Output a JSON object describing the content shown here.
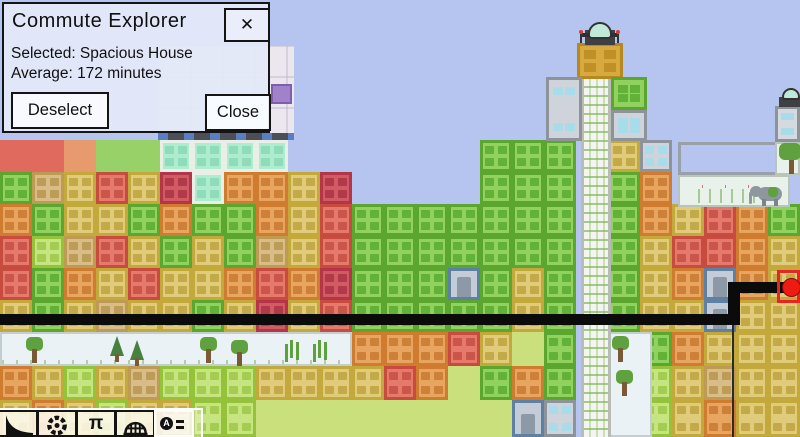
{
  "window": {
    "title": "Commute Explorer",
    "close_x": "✕"
  },
  "dialog": {
    "selected_line": "Selected: Spacious House",
    "average_line": "Average: 172 minutes",
    "deselect_label": "Deselect",
    "close_label": "Close"
  },
  "toolbar": {
    "pi_glyph": "π",
    "explore_glyph": "A",
    "buttons": [
      {
        "name": "road-tool",
        "active": false
      },
      {
        "name": "gear-tool",
        "active": false
      },
      {
        "name": "structure-tool",
        "active": false
      },
      {
        "name": "dome-tool",
        "active": false
      },
      {
        "name": "explore-tool",
        "active": true
      }
    ]
  },
  "map": {
    "colors": {
      "sky": "#b6c4f0",
      "park_bg": "#eaf2f5",
      "park_frame": "#c3ced2",
      "zoo_bg": "#e9f2ea",
      "tree": "#5ea13e",
      "pine": "#46813d",
      "trunk": "#7a5a36",
      "shaft_bg": "#f4f4f0",
      "shaft_edge": "#b9bcb4",
      "gold_frame": "#b5891f",
      "gold_body": "#d8a93e",
      "gold_win": "#bf8f28",
      "dome": "#bfe9d9",
      "elephant": "#8f979e",
      "route": "#0b0b0b",
      "dot": "#ee1b12",
      "select": "#e82520"
    },
    "palette": {
      "R": {
        "frame": "#c84b40",
        "body": "#e5796b",
        "win": "#c9554b"
      },
      "K": {
        "frame": "#b43448",
        "body": "#d25a62",
        "win": "#b03a4a"
      },
      "O": {
        "frame": "#cf7c30",
        "body": "#e7a55f",
        "win": "#cd8138"
      },
      "Y": {
        "frame": "#c3a93c",
        "body": "#dfcb79",
        "win": "#c4a948"
      },
      "T": {
        "frame": "#bd9b52",
        "body": "#d8bd88",
        "win": "#bd9c58"
      },
      "G": {
        "frame": "#5aa62e",
        "body": "#90d160",
        "win": "#63b238"
      },
      "L": {
        "frame": "#94c23a",
        "body": "#c6e580",
        "win": "#a3cc50"
      },
      "C": {
        "frame": "#e9efe7",
        "body": "#aeeccf",
        "win": "#8edcba"
      },
      "W": {
        "frame": "#8d939b",
        "body": "#ced4da",
        "win": "#a8dcea"
      },
      "E": {
        "frame": "#5e80a2",
        "body": "#c4cdd7",
        "win": "#8d99a6",
        "door": true
      },
      "S": {
        "frame": "#c3a93c",
        "body": "#dfcb79",
        "win": "#c4a948"
      },
      "Rf": {
        "body": "#e06a5e",
        "flat": true
      },
      "Of": {
        "body": "#e79a6d",
        "flat": true
      },
      "Gf": {
        "body": "#98d167",
        "flat": true
      },
      "gr": {
        "body": "#c9e07c",
        "flat": true
      }
    },
    "grid": {
      "tile": 32,
      "rows": [
        {
          "y": 140,
          "h": 32,
          "cells": [
            "Rf",
            "Rf",
            "Of",
            "Gf",
            "Gf",
            "C",
            "C",
            "C",
            "C",
            ".",
            ".",
            ".",
            ".",
            ".",
            ".",
            "G",
            "G",
            "G",
            ".",
            "Y",
            "W",
            ".",
            ".",
            ".",
            "."
          ]
        },
        {
          "y": 172,
          "h": 32,
          "cells": [
            "G",
            "T",
            "Y",
            "R",
            "Y",
            "K",
            "C",
            "O",
            "O",
            "Y",
            "K",
            ".",
            ".",
            ".",
            ".",
            "G",
            "G",
            "G",
            ".",
            "G",
            "O",
            ".",
            ".",
            ".",
            "."
          ]
        },
        {
          "y": 204,
          "h": 32,
          "cells": [
            "O",
            "G",
            "Y",
            "Y",
            "G",
            "O",
            "G",
            "G",
            "O",
            "Y",
            "R",
            "G",
            "G",
            "G",
            "G",
            "G",
            "G",
            "G",
            ".",
            "G",
            "O",
            "Y",
            "R",
            "O",
            "G"
          ]
        },
        {
          "y": 236,
          "h": 32,
          "cells": [
            "R",
            "L",
            "T",
            "R",
            "Y",
            "G",
            "Y",
            "G",
            "T",
            "Y",
            "R",
            "G",
            "G",
            "G",
            "G",
            "G",
            "G",
            "G",
            ".",
            "G",
            "Y",
            "R",
            "R",
            "O",
            "Y"
          ]
        },
        {
          "y": 268,
          "h": 32,
          "cells": [
            "R",
            "G",
            "O",
            "Y",
            "R",
            "Y",
            "Y",
            "O",
            "R",
            "O",
            "K",
            "G",
            "G",
            "G",
            "E",
            "G",
            "Y",
            "G",
            ".",
            "G",
            "Y",
            "O",
            "E",
            "O",
            "S"
          ]
        },
        {
          "y": 300,
          "h": 32,
          "cells": [
            "Y",
            "G",
            "Y",
            "T",
            "Y",
            "Y",
            "G",
            "Y",
            "K",
            "Y",
            "R",
            "G",
            "G",
            "G",
            "G",
            "G",
            "Y",
            "G",
            ".",
            "G",
            "Y",
            "Y",
            "E",
            "Y",
            "Y"
          ]
        },
        {
          "y": 332,
          "h": 34,
          "cells": [
            ".",
            ".",
            ".",
            ".",
            ".",
            ".",
            ".",
            ".",
            ".",
            ".",
            ".",
            "O",
            "O",
            "O",
            "R",
            "Y",
            "gr",
            "G",
            ".",
            ".",
            "G",
            "O",
            "Y",
            "Y",
            "Y"
          ]
        },
        {
          "y": 366,
          "h": 34,
          "cells": [
            "O",
            "Y",
            "L",
            "Y",
            "T",
            "L",
            "L",
            "L",
            "Y",
            "Y",
            "Y",
            "Y",
            "R",
            "O",
            "gr",
            "G",
            "O",
            "G",
            ".",
            ".",
            "L",
            "Y",
            "T",
            "Y",
            "Y"
          ]
        },
        {
          "y": 400,
          "h": 37,
          "cells": [
            "Y",
            "O",
            "Y",
            "L",
            "Y",
            "Y",
            "L",
            "L",
            "gr",
            "gr",
            "gr",
            "gr",
            "gr",
            "gr",
            "gr",
            "gr",
            "E",
            "W",
            ".",
            ".",
            "L",
            "Y",
            "O",
            "Y",
            "Y"
          ]
        }
      ]
    },
    "park": {
      "trees": [
        {
          "x": 26,
          "y": 337,
          "type": "round"
        },
        {
          "x": 110,
          "y": 336,
          "type": "pine"
        },
        {
          "x": 130,
          "y": 340,
          "type": "pine"
        },
        {
          "x": 200,
          "y": 337,
          "type": "round"
        },
        {
          "x": 231,
          "y": 340,
          "type": "round"
        },
        {
          "x": 290,
          "y": 340,
          "type": "sprig"
        },
        {
          "x": 318,
          "y": 340,
          "type": "sprig"
        },
        {
          "x": 612,
          "y": 336,
          "type": "round"
        },
        {
          "x": 616,
          "y": 370,
          "type": "round"
        }
      ]
    },
    "route": {
      "segments": [
        {
          "x": 0,
          "y": 314,
          "w": 740,
          "h": 11
        },
        {
          "x": 728,
          "y": 283,
          "w": 12,
          "h": 42
        },
        {
          "x": 728,
          "y": 282,
          "w": 64,
          "h": 11
        }
      ],
      "dot": {
        "x": 782,
        "y": 278
      }
    },
    "selection": {
      "x": 777,
      "y": 270,
      "w": 23,
      "h": 33
    }
  }
}
